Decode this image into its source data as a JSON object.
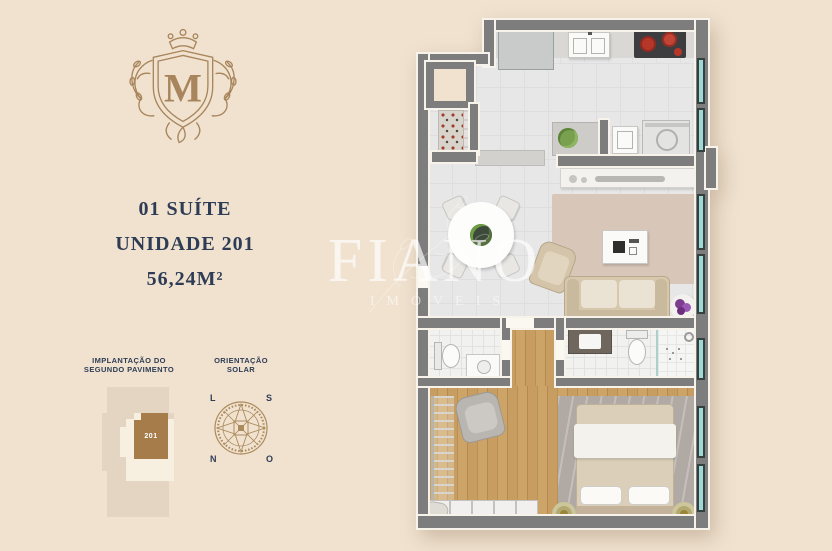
{
  "colors": {
    "background": "#f0e2cf",
    "navy": "#2e3c55",
    "gold": "#a8855c",
    "unit_brown": "#a57c4a",
    "wall_gray": "#7d7d7d",
    "window_teal": "#9fd9d6"
  },
  "logo": {
    "letter": "M"
  },
  "unit": {
    "suite_line": "01 SUÍTE",
    "unit_line": "UNIDADE 201",
    "area_line": "56,24M²"
  },
  "site_plan": {
    "title_line1": "IMPLANTAÇÃO DO",
    "title_line2": "SEGUNDO PAVIMENTO",
    "unit_number": "201"
  },
  "solar": {
    "title_line1": "ORIENTAÇÃO",
    "title_line2": "SOLAR",
    "top_left": "L",
    "top_right": "S",
    "bottom_left": "N",
    "bottom_right": "O"
  },
  "watermark": {
    "brand": "FIANO",
    "sub": "IMÓVEIS"
  }
}
